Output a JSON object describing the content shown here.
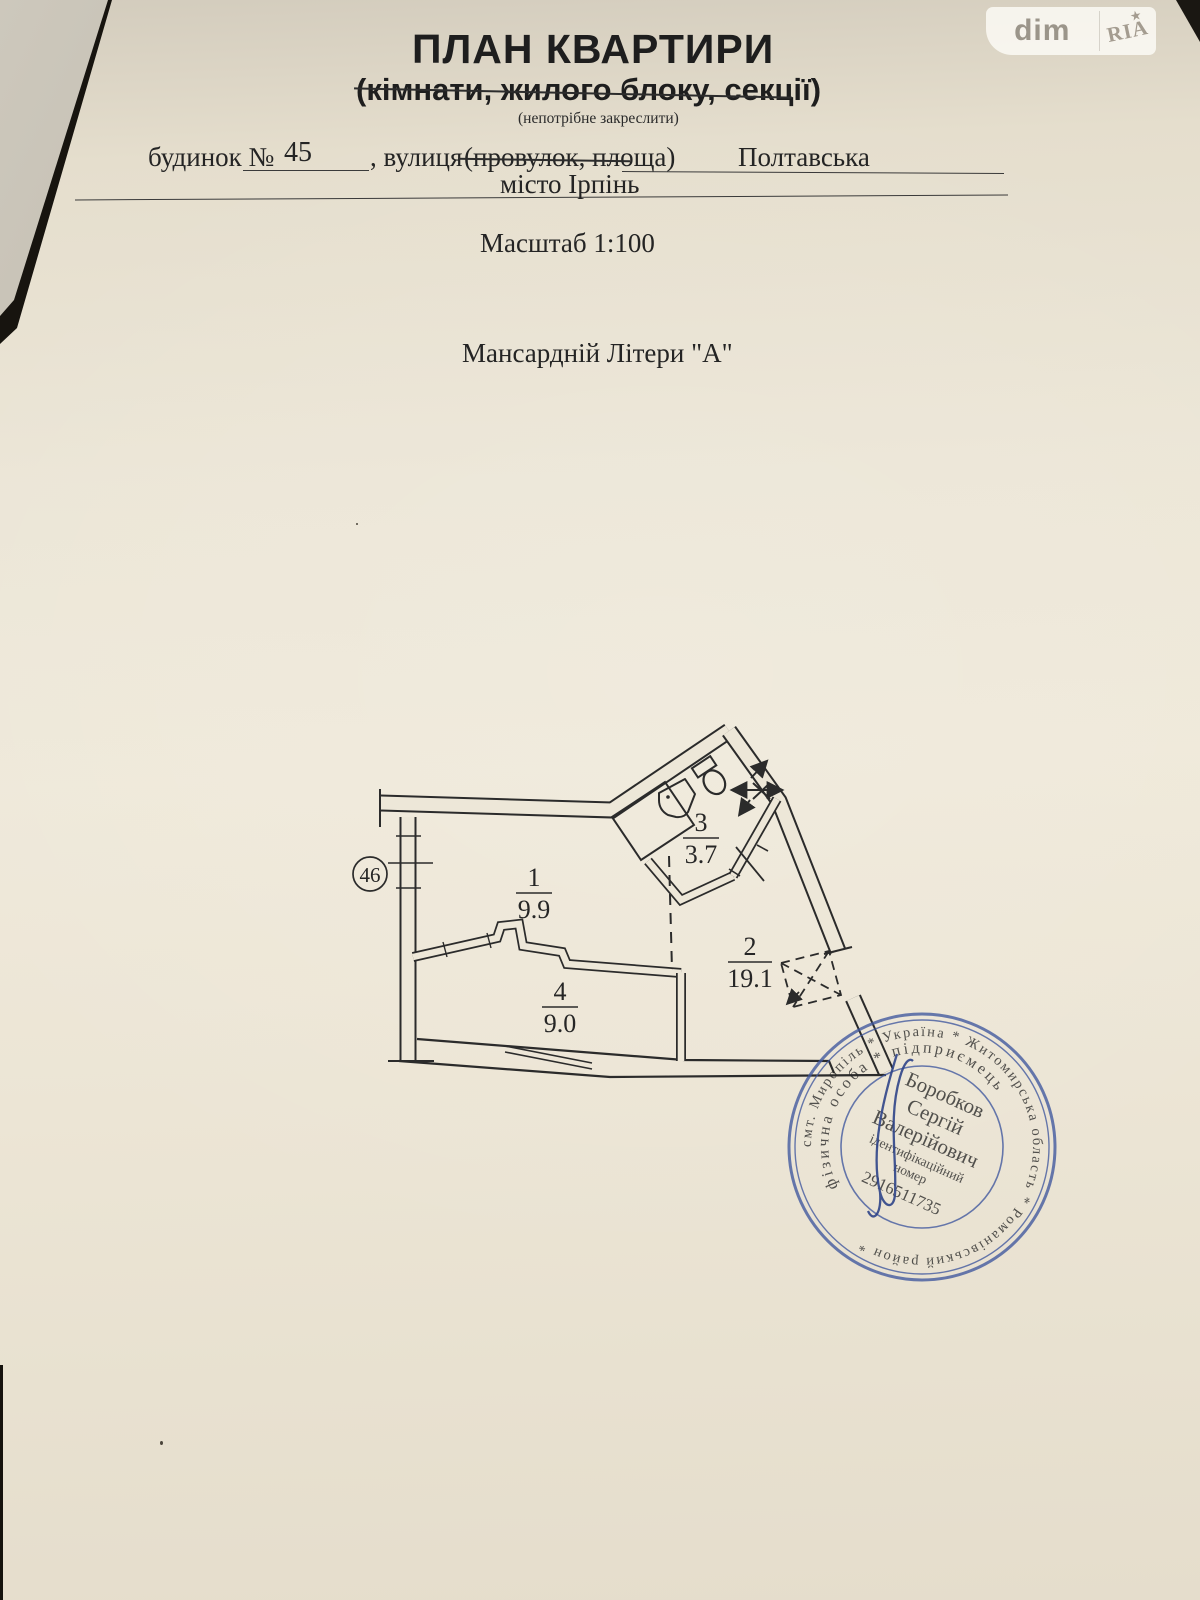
{
  "watermark": {
    "dim": "dim",
    "ria": "RIA",
    "star": "★"
  },
  "header": {
    "title": "ПЛАН КВАРТИРИ",
    "subtitle": "(кімнати, жилого блоку, секції)",
    "note": "(непотрібне закреслити)",
    "building_label": "будинок №",
    "building_number": "45",
    "street_label": ", вулиця",
    "street_label_struck": "(провулок, площа)",
    "street_value": "Полтавська",
    "city_line": "місто Ірпінь",
    "scale_line": "Масштаб 1:100",
    "floor_line": "Мансардній Літери \"А\""
  },
  "plan": {
    "unit_number": "46",
    "rooms": [
      {
        "number": "1",
        "area": "9.9"
      },
      {
        "number": "2",
        "area": "19.1"
      },
      {
        "number": "3",
        "area": "3.7"
      },
      {
        "number": "4",
        "area": "9.0"
      }
    ]
  },
  "stamp": {
    "ring_text": "смт. Миропіль * Україна * Житомирська область * Романівський район *",
    "inner_ring_text": "фізична особа * підприємець",
    "name_surname": "Боробков",
    "name_first": "Сергій",
    "name_patronymic": "Валерійович",
    "id_label_1": "ідентифікаційний",
    "id_label_2": "номер",
    "id_number": "2916511735"
  }
}
